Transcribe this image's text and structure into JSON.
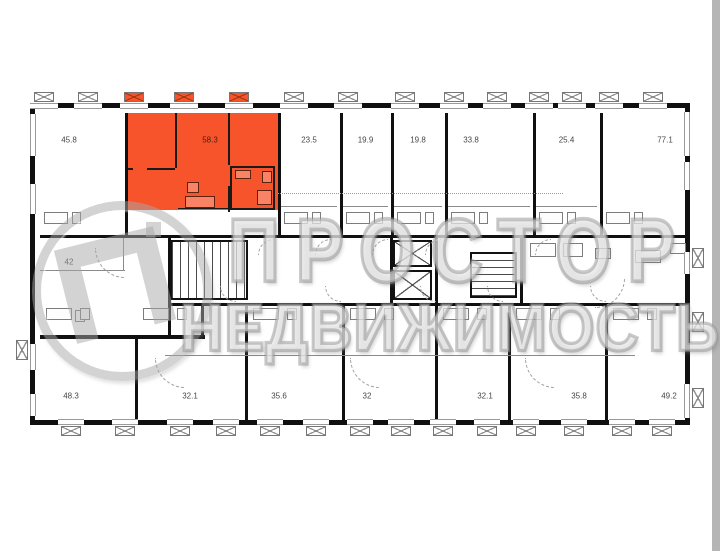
{
  "watermark": {
    "brand": "ПРОСТОР",
    "subtitle": "НЕДВИЖИМОСТЬ",
    "logo": "letter-P-in-circle"
  },
  "palette": {
    "highlight": "#F8542B",
    "wall": "#101010",
    "watermark_gray": "#a8a8a8",
    "right_strip": "#b5b5b5"
  },
  "floorplan": {
    "highlighted_unit_area": "58.3",
    "units_top": [
      {
        "area": "45.8",
        "x": 3,
        "w": 87,
        "lx": 34
      },
      {
        "area": "58.3",
        "x": 90,
        "w": 153,
        "lx": 175,
        "highlighted": true
      },
      {
        "area": "23.5",
        "x": 243,
        "w": 62
      },
      {
        "area": "19.9",
        "x": 305,
        "w": 51
      },
      {
        "area": "19.8",
        "x": 356,
        "w": 54
      },
      {
        "area": "33.8",
        "x": 410,
        "w": 88,
        "lx": 436
      },
      {
        "area": "25.4",
        "x": 498,
        "w": 67
      },
      {
        "area": "77.1",
        "x": 565,
        "w": 93,
        "lx": 630
      }
    ],
    "unit_middle": {
      "area": "42",
      "lx": 34,
      "ly": 154
    },
    "units_bottom": [
      {
        "area": "48.3",
        "x": 3,
        "w": 97,
        "lx": 36
      },
      {
        "area": "32.1",
        "x": 100,
        "w": 110
      },
      {
        "area": "35.6",
        "x": 210,
        "w": 97,
        "lx": 244
      },
      {
        "area": "32",
        "x": 307,
        "w": 93,
        "lx": 332
      },
      {
        "area": "32.1",
        "x": 400,
        "w": 73,
        "lx": 450
      },
      {
        "area": "35.8",
        "x": 473,
        "w": 97,
        "lx": 544
      },
      {
        "area": "49.2",
        "x": 570,
        "w": 88,
        "lx": 634
      }
    ]
  }
}
